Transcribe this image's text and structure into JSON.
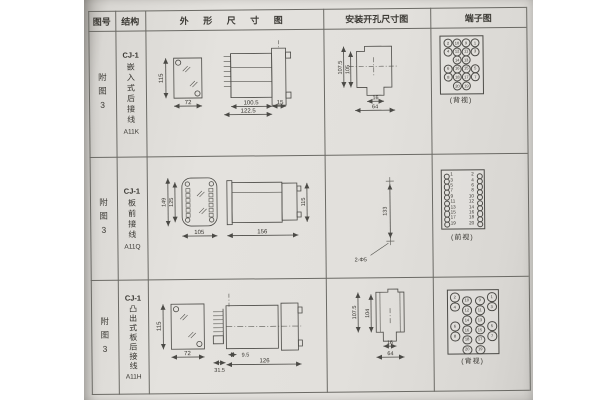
{
  "table": {
    "headers": {
      "fig_no": "图号",
      "structure": "结构",
      "outline": "外 形 尺 寸 图",
      "install": "安装开孔尺寸图",
      "terminal": "端子图"
    },
    "rows": [
      {
        "fig_no": "附图3",
        "structure": {
          "model": "CJ-1",
          "type": "嵌入式后接线",
          "code": "A11K"
        },
        "outline": {
          "front_height": "115",
          "front_width": "72",
          "body_length": "100.5",
          "total_length": "122.5",
          "flange_depth": "15"
        },
        "install": {
          "outer_height": "107.5",
          "inner_height": "105",
          "slot_width": "16",
          "opening_width": "64"
        },
        "terminal": {
          "layout": "grid",
          "view_label": "(背视)",
          "grid": [
            [
              "2",
              "10",
              "9",
              "1"
            ],
            [
              "4",
              "12",
              "11",
              "3"
            ],
            [
              "",
              "14",
              "13",
              ""
            ],
            [
              "6",
              "16",
              "15",
              "5"
            ],
            [
              "8",
              "18",
              "17",
              "7"
            ],
            [
              "",
              "20",
              "19",
              ""
            ]
          ]
        }
      },
      {
        "fig_no": "附图3",
        "structure": {
          "model": "CJ-1",
          "type": "板前接线",
          "code": "A11Q"
        },
        "outline": {
          "outer_height": "149",
          "inner_height": "125",
          "width": "105",
          "side_length": "156",
          "side_height": "115"
        },
        "install": {
          "hole_pitch": "133",
          "hole_note": "2-Φ5"
        },
        "terminal": {
          "layout": "dual",
          "view_label": "(前视)",
          "left": [
            "1",
            "3",
            "5",
            "7",
            "9",
            "11",
            "13",
            "15",
            "17",
            "19"
          ],
          "right": [
            "2",
            "4",
            "6",
            "8",
            "10",
            "12",
            "14",
            "16",
            "18",
            "20"
          ]
        }
      },
      {
        "fig_no": "附图3",
        "structure": {
          "model": "CJ-1",
          "type": "凸出式板后接线",
          "code": "A11H"
        },
        "outline": {
          "front_height": "115",
          "front_width": "72",
          "comb_width": "31.5",
          "offset": "9.5",
          "body_length": "126"
        },
        "install": {
          "outer_height": "107.5",
          "inner_height": "104",
          "slot_width": "16",
          "opening_width": "64"
        },
        "terminal": {
          "layout": "staggered",
          "view_label": "(背视)",
          "grid": [
            [
              "2",
              "10",
              "9",
              "1"
            ],
            [
              "4",
              "12",
              "11",
              "3"
            ],
            [
              "",
              "14",
              "13",
              ""
            ],
            [
              "6",
              "16",
              "15",
              "5"
            ],
            [
              "8",
              "18",
              "17",
              "7"
            ],
            [
              "",
              "20",
              "19",
              ""
            ]
          ]
        }
      }
    ]
  }
}
